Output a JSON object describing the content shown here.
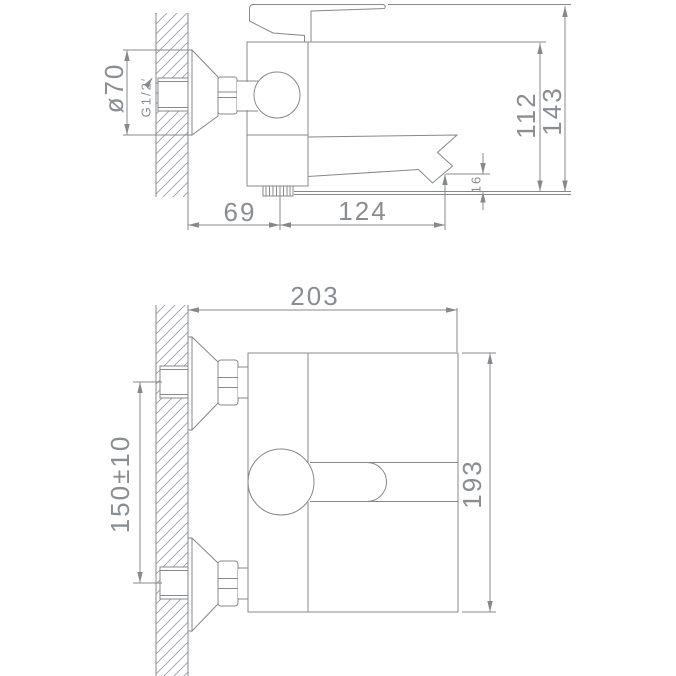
{
  "colors": {
    "line": "#85888c",
    "text": "#8a8d91",
    "hatch": "#9aa0a4",
    "background": "#ffffff"
  },
  "drawing": {
    "type": "technical-dimension-drawing",
    "subject": "wall-mounted single-lever bath mixer faucet",
    "side_view": {
      "dim_escutcheon_diameter": "ø70",
      "dim_thread_size": "G1/2′",
      "dim_body_height": "112",
      "dim_overall_height": "143",
      "dim_spout_end_height": "16",
      "dim_wall_to_outlet": "69",
      "dim_outlet_to_spout_tip": "124"
    },
    "plan_view": {
      "dim_wall_to_spout_tip": "203",
      "dim_overall_length": "193",
      "dim_inlet_spacing": "150±10"
    }
  }
}
